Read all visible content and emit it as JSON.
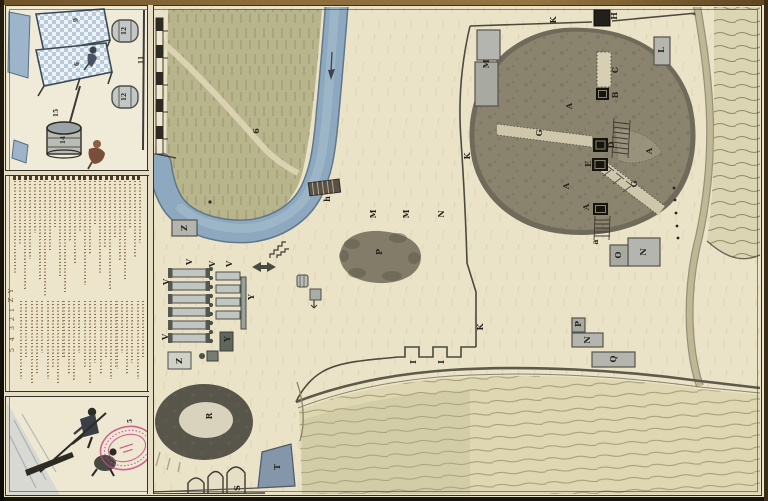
{
  "artifact": {
    "kind_label": "hand-drawn manuscript plan with watercolor",
    "orientation_note": "lettering drawn rotated 90° counter-clockwise"
  },
  "colors": {
    "paper": "#ebe3c8",
    "river_blue": "#8da8bf",
    "field_green": "#b8b48c",
    "mound_gray": "#878069",
    "ink": "#34312a",
    "manuscript_ink": "#8a6d48",
    "stamp_pink": "#c2457e",
    "building_gray": "#b3b5ae",
    "black_structure": "#16140f"
  },
  "map": {
    "letter_labels": [
      {
        "text": "6",
        "x": 256,
        "y": 131
      },
      {
        "text": "h",
        "x": 327,
        "y": 199
      },
      {
        "text": "M",
        "x": 373,
        "y": 214
      },
      {
        "text": "M",
        "x": 406,
        "y": 214
      },
      {
        "text": "N",
        "x": 441,
        "y": 214
      },
      {
        "text": "Z",
        "x": 184,
        "y": 228
      },
      {
        "text": "P",
        "x": 379,
        "y": 252
      },
      {
        "text": "V",
        "x": 189,
        "y": 262
      },
      {
        "text": "V",
        "x": 212,
        "y": 264
      },
      {
        "text": "V",
        "x": 229,
        "y": 264
      },
      {
        "text": "V",
        "x": 166,
        "y": 282
      },
      {
        "text": "V",
        "x": 165,
        "y": 337
      },
      {
        "text": "Y",
        "x": 251,
        "y": 297
      },
      {
        "text": "Y",
        "x": 227,
        "y": 339
      },
      {
        "text": "Z",
        "x": 179,
        "y": 361
      },
      {
        "text": "M",
        "x": 486,
        "y": 64
      },
      {
        "text": "K",
        "x": 553,
        "y": 20
      },
      {
        "text": "H",
        "x": 614,
        "y": 16
      },
      {
        "text": "C",
        "x": 615,
        "y": 70
      },
      {
        "text": "B",
        "x": 615,
        "y": 95
      },
      {
        "text": "A",
        "x": 569,
        "y": 106
      },
      {
        "text": "A",
        "x": 649,
        "y": 151
      },
      {
        "text": "A",
        "x": 566,
        "y": 186
      },
      {
        "text": "A",
        "x": 586,
        "y": 207
      },
      {
        "text": "G",
        "x": 539,
        "y": 133
      },
      {
        "text": "G",
        "x": 634,
        "y": 184
      },
      {
        "text": "D",
        "x": 611,
        "y": 145
      },
      {
        "text": "E",
        "x": 588,
        "y": 164
      },
      {
        "text": "a",
        "x": 595,
        "y": 242
      },
      {
        "text": "K",
        "x": 467,
        "y": 156
      },
      {
        "text": "K",
        "x": 480,
        "y": 327
      },
      {
        "text": "I",
        "x": 413,
        "y": 362
      },
      {
        "text": "I",
        "x": 441,
        "y": 362
      },
      {
        "text": "L",
        "x": 661,
        "y": 50
      },
      {
        "text": "O",
        "x": 618,
        "y": 255
      },
      {
        "text": "N",
        "x": 643,
        "y": 252
      },
      {
        "text": "P",
        "x": 578,
        "y": 324
      },
      {
        "text": "N",
        "x": 587,
        "y": 340
      },
      {
        "text": "Q",
        "x": 613,
        "y": 359
      },
      {
        "text": "R",
        "x": 209,
        "y": 416
      },
      {
        "text": "S",
        "x": 237,
        "y": 488
      },
      {
        "text": "T",
        "x": 277,
        "y": 467
      }
    ]
  },
  "legend": {
    "visible_keys": [
      {
        "text": "Y",
        "x": 11,
        "y": 291
      },
      {
        "text": "Z",
        "x": 11,
        "y": 300
      },
      {
        "text": "1",
        "x": 12,
        "y": 310
      },
      {
        "text": "2",
        "x": 12,
        "y": 319
      },
      {
        "text": "3",
        "x": 12,
        "y": 328
      },
      {
        "text": "4",
        "x": 12,
        "y": 339
      },
      {
        "text": "5",
        "x": 12,
        "y": 350
      }
    ]
  },
  "insets": {
    "top_numbers": [
      {
        "text": "9",
        "x": 77,
        "y": 20
      },
      {
        "text": "6",
        "x": 78,
        "y": 64
      },
      {
        "text": "12",
        "x": 125,
        "y": 31
      },
      {
        "text": "12",
        "x": 125,
        "y": 97
      },
      {
        "text": "11",
        "x": 142,
        "y": 60
      },
      {
        "text": "15",
        "x": 57,
        "y": 113
      },
      {
        "text": "14",
        "x": 64,
        "y": 140
      }
    ],
    "bottom_numbers": [
      {
        "text": "5",
        "x": 131,
        "y": 421
      }
    ]
  }
}
